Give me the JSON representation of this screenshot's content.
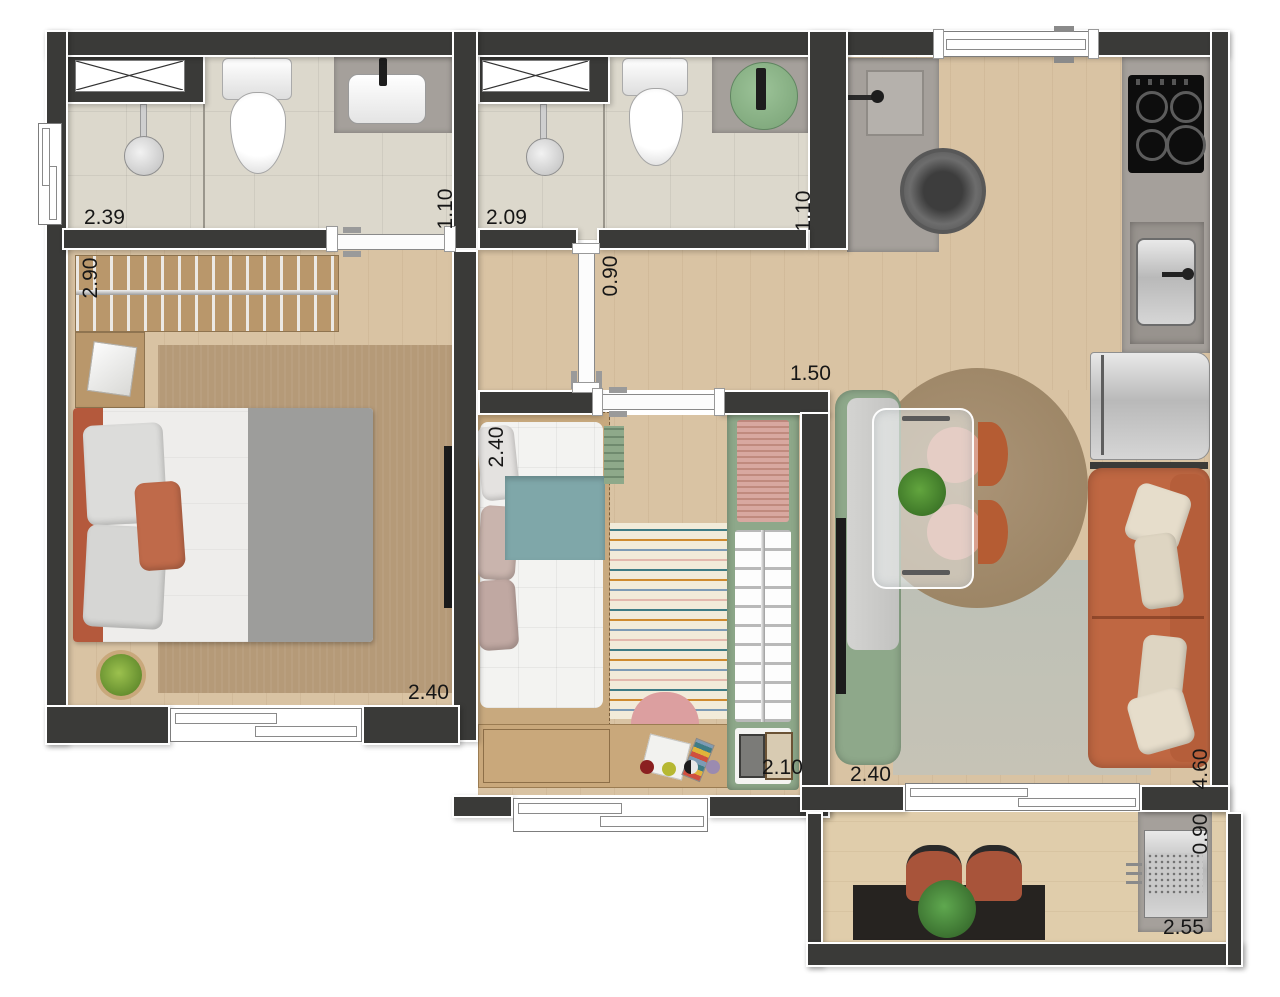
{
  "plan_type": "apartment-floor-plan-top-view",
  "dimensions": {
    "bathroom1_width": "2.39",
    "bathroom1_depth": "1.10",
    "bathroom2_width": "2.09",
    "bathroom2_depth": "1.10",
    "closet_width": "2.90",
    "hallway_width": "0.90",
    "living_opening_width": "1.50",
    "bedroom2_bed_length": "2.40",
    "master_bedroom_width": "2.40",
    "bedroom2_width": "2.10",
    "living_width": "2.40",
    "living_depth": "4.60",
    "balcony_depth": "0.90",
    "balcony_width": "2.55"
  },
  "colors": {
    "wall": "#3a3a38",
    "wall_outline": "#ffffff",
    "wood_floor": "#d9c3a3",
    "balcony_floor": "#e0cdab",
    "bathroom_tile": "#dcd8cc",
    "counter_gray": "#a5a09b",
    "accent_green": "#8ea88a",
    "accent_terracotta": "#bf6742",
    "teal_blanket": "#7fa7a9",
    "master_rug": "#b59a78",
    "round_rug": "#a18a6c",
    "living_rug": "#bcc0b6",
    "pink": "#d8a8a0"
  },
  "furniture": {
    "bathroom1": [
      "shower-head",
      "toilet",
      "vanity-sink",
      "ventilation-shaft-window"
    ],
    "bathroom2": [
      "shower-head",
      "toilet",
      "green-vessel-sink",
      "ventilation-shaft-window"
    ],
    "laundry": [
      "washtub",
      "washing-machine"
    ],
    "kitchen": [
      "gas-cooktop",
      "kitchen-sink",
      "refrigerator"
    ],
    "living": [
      "green-banquette",
      "glass-dining-table",
      "dining-chairs",
      "table-plant",
      "tv",
      "round-rug",
      "area-rug",
      "terracotta-sofa"
    ],
    "master_bedroom": [
      "open-closet-rail",
      "nightstand-basket",
      "double-bed",
      "rug",
      "plant",
      "tv"
    ],
    "bedroom2": [
      "single-bed",
      "teal-blanket",
      "striped-rug",
      "pouf",
      "toys",
      "desk",
      "green-wardrobe"
    ],
    "balcony": [
      "bar-counter",
      "plant",
      "two-chairs",
      "barbecue-grill"
    ]
  }
}
